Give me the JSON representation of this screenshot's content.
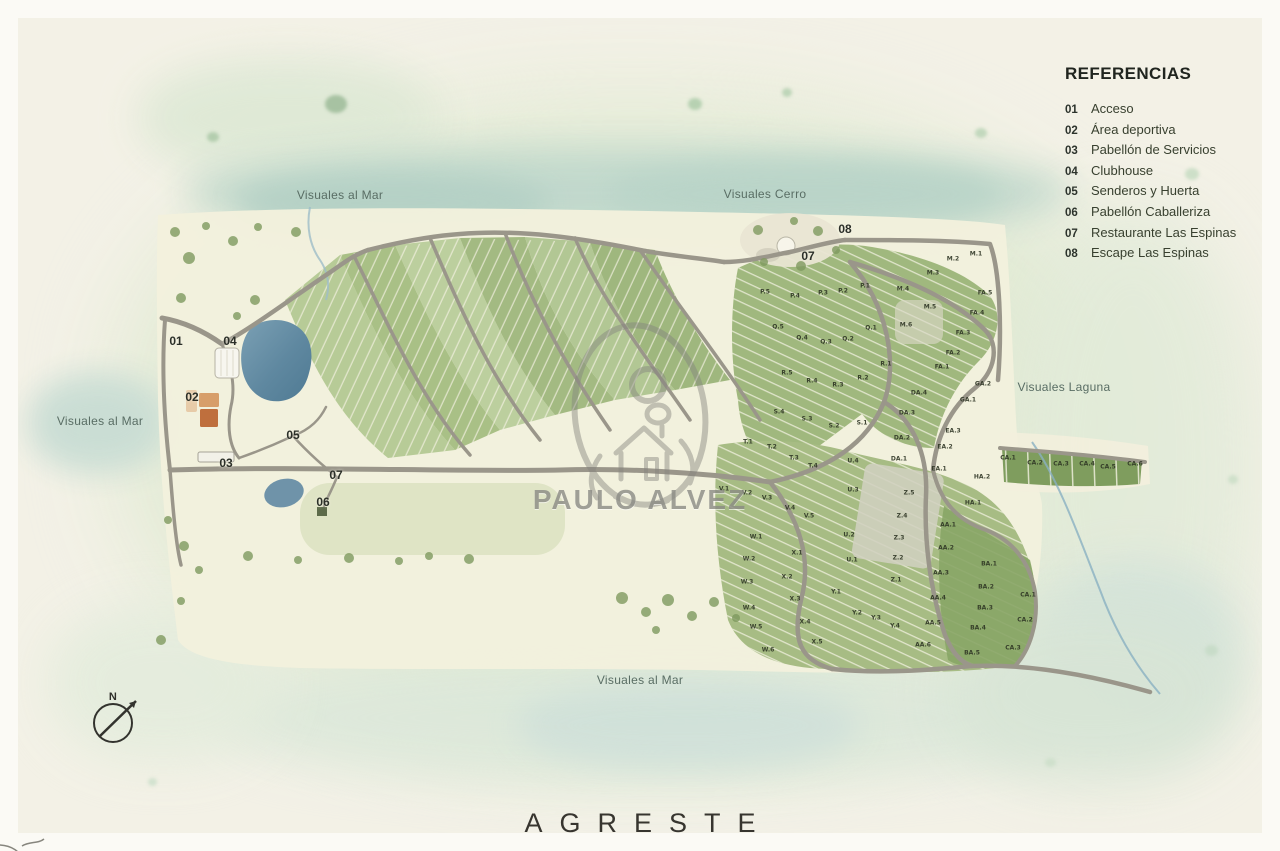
{
  "page": {
    "brand": "AGRESTE",
    "watermark": "PAULO ALVEZ",
    "compass_label": "N"
  },
  "legend": {
    "title": "REFERENCIAS",
    "items": [
      {
        "num": "01",
        "label": "Acceso"
      },
      {
        "num": "02",
        "label": "Área deportiva"
      },
      {
        "num": "03",
        "label": "Pabellón de Servicios"
      },
      {
        "num": "04",
        "label": "Clubhouse"
      },
      {
        "num": "05",
        "label": "Senderos y Huerta"
      },
      {
        "num": "06",
        "label": "Pabellón Caballeriza"
      },
      {
        "num": "07",
        "label": "Restaurante Las Espinas"
      },
      {
        "num": "08",
        "label": "Escape Las Espinas"
      }
    ]
  },
  "map": {
    "view_labels": [
      {
        "text": "Visuales al Mar",
        "x": 340,
        "y": 195
      },
      {
        "text": "Visuales Cerro",
        "x": 765,
        "y": 194
      },
      {
        "text": "Visuales al Mar",
        "x": 100,
        "y": 421
      },
      {
        "text": "Visuales Laguna",
        "x": 1064,
        "y": 387
      },
      {
        "text": "Visuales al Mar",
        "x": 640,
        "y": 680
      }
    ],
    "markers": [
      {
        "num": "01",
        "x": 176,
        "y": 341
      },
      {
        "num": "02",
        "x": 192,
        "y": 397
      },
      {
        "num": "03",
        "x": 226,
        "y": 463
      },
      {
        "num": "04",
        "x": 230,
        "y": 341
      },
      {
        "num": "05",
        "x": 293,
        "y": 435
      },
      {
        "num": "06",
        "x": 323,
        "y": 502
      },
      {
        "num": "07",
        "x": 336,
        "y": 475
      },
      {
        "num": "07",
        "x": 808,
        "y": 256
      },
      {
        "num": "08",
        "x": 845,
        "y": 229
      }
    ],
    "lots": [
      {
        "code": "P.5",
        "x": 765,
        "y": 292
      },
      {
        "code": "P.4",
        "x": 795,
        "y": 296
      },
      {
        "code": "P.3",
        "x": 823,
        "y": 293
      },
      {
        "code": "P.2",
        "x": 843,
        "y": 291
      },
      {
        "code": "P.1",
        "x": 865,
        "y": 286
      },
      {
        "code": "M.4",
        "x": 903,
        "y": 289
      },
      {
        "code": "M.3",
        "x": 933,
        "y": 273
      },
      {
        "code": "M.2",
        "x": 953,
        "y": 259
      },
      {
        "code": "M.1",
        "x": 976,
        "y": 254
      },
      {
        "code": "M.5",
        "x": 930,
        "y": 307
      },
      {
        "code": "M.6",
        "x": 906,
        "y": 325
      },
      {
        "code": "Q.5",
        "x": 778,
        "y": 327
      },
      {
        "code": "Q.4",
        "x": 802,
        "y": 338
      },
      {
        "code": "Q.3",
        "x": 826,
        "y": 342
      },
      {
        "code": "Q.2",
        "x": 848,
        "y": 339
      },
      {
        "code": "Q.1",
        "x": 871,
        "y": 328
      },
      {
        "code": "R.5",
        "x": 787,
        "y": 373
      },
      {
        "code": "R.4",
        "x": 812,
        "y": 381
      },
      {
        "code": "R.3",
        "x": 838,
        "y": 385
      },
      {
        "code": "R.2",
        "x": 863,
        "y": 378
      },
      {
        "code": "R.1",
        "x": 886,
        "y": 364
      },
      {
        "code": "S.4",
        "x": 779,
        "y": 412
      },
      {
        "code": "S.3",
        "x": 807,
        "y": 419
      },
      {
        "code": "S.2",
        "x": 834,
        "y": 426
      },
      {
        "code": "S.1",
        "x": 862,
        "y": 423
      },
      {
        "code": "T.1",
        "x": 748,
        "y": 442
      },
      {
        "code": "T.2",
        "x": 772,
        "y": 447
      },
      {
        "code": "T.3",
        "x": 794,
        "y": 458
      },
      {
        "code": "T.4",
        "x": 813,
        "y": 466
      },
      {
        "code": "U.4",
        "x": 853,
        "y": 461
      },
      {
        "code": "U.3",
        "x": 853,
        "y": 490
      },
      {
        "code": "U.2",
        "x": 849,
        "y": 535
      },
      {
        "code": "U.1",
        "x": 852,
        "y": 560
      },
      {
        "code": "V.1",
        "x": 724,
        "y": 489
      },
      {
        "code": "V.2",
        "x": 747,
        "y": 493
      },
      {
        "code": "V.3",
        "x": 767,
        "y": 498
      },
      {
        "code": "V.4",
        "x": 790,
        "y": 508
      },
      {
        "code": "V.5",
        "x": 809,
        "y": 516
      },
      {
        "code": "W.1",
        "x": 756,
        "y": 537
      },
      {
        "code": "W.2",
        "x": 749,
        "y": 559
      },
      {
        "code": "W.3",
        "x": 747,
        "y": 582
      },
      {
        "code": "W.4",
        "x": 749,
        "y": 608
      },
      {
        "code": "W.5",
        "x": 756,
        "y": 627
      },
      {
        "code": "W.6",
        "x": 768,
        "y": 650
      },
      {
        "code": "X.1",
        "x": 797,
        "y": 553
      },
      {
        "code": "X.2",
        "x": 787,
        "y": 577
      },
      {
        "code": "X.3",
        "x": 795,
        "y": 599
      },
      {
        "code": "X.4",
        "x": 805,
        "y": 622
      },
      {
        "code": "X.5",
        "x": 817,
        "y": 642
      },
      {
        "code": "Y.1",
        "x": 836,
        "y": 592
      },
      {
        "code": "Y.2",
        "x": 857,
        "y": 613
      },
      {
        "code": "Y.3",
        "x": 876,
        "y": 618
      },
      {
        "code": "Y.4",
        "x": 895,
        "y": 626
      },
      {
        "code": "Z.5",
        "x": 909,
        "y": 493
      },
      {
        "code": "Z.4",
        "x": 902,
        "y": 516
      },
      {
        "code": "Z.3",
        "x": 899,
        "y": 538
      },
      {
        "code": "Z.2",
        "x": 898,
        "y": 558
      },
      {
        "code": "Z.1",
        "x": 896,
        "y": 580
      },
      {
        "code": "AA.1",
        "x": 948,
        "y": 525
      },
      {
        "code": "AA.2",
        "x": 946,
        "y": 548
      },
      {
        "code": "AA.3",
        "x": 941,
        "y": 573
      },
      {
        "code": "AA.4",
        "x": 938,
        "y": 598
      },
      {
        "code": "AA.5",
        "x": 933,
        "y": 623
      },
      {
        "code": "AA.6",
        "x": 923,
        "y": 645
      },
      {
        "code": "BA.1",
        "x": 989,
        "y": 564
      },
      {
        "code": "BA.2",
        "x": 986,
        "y": 587
      },
      {
        "code": "BA.3",
        "x": 985,
        "y": 608
      },
      {
        "code": "BA.4",
        "x": 978,
        "y": 628
      },
      {
        "code": "BA.5",
        "x": 972,
        "y": 653
      },
      {
        "code": "CA.1",
        "x": 1028,
        "y": 595
      },
      {
        "code": "CA.2",
        "x": 1025,
        "y": 620
      },
      {
        "code": "CA.3",
        "x": 1013,
        "y": 648
      },
      {
        "code": "CA.1",
        "x": 1008,
        "y": 458
      },
      {
        "code": "CA.2",
        "x": 1035,
        "y": 463
      },
      {
        "code": "CA.3",
        "x": 1061,
        "y": 464
      },
      {
        "code": "CA.4",
        "x": 1087,
        "y": 464
      },
      {
        "code": "CA.5",
        "x": 1108,
        "y": 467
      },
      {
        "code": "CA.6",
        "x": 1135,
        "y": 464
      },
      {
        "code": "DA.1",
        "x": 899,
        "y": 459
      },
      {
        "code": "DA.2",
        "x": 902,
        "y": 438
      },
      {
        "code": "DA.3",
        "x": 907,
        "y": 413
      },
      {
        "code": "DA.4",
        "x": 919,
        "y": 393
      },
      {
        "code": "EA.1",
        "x": 939,
        "y": 469
      },
      {
        "code": "EA.2",
        "x": 945,
        "y": 447
      },
      {
        "code": "EA.3",
        "x": 953,
        "y": 431
      },
      {
        "code": "FA.1",
        "x": 942,
        "y": 367
      },
      {
        "code": "FA.2",
        "x": 953,
        "y": 353
      },
      {
        "code": "FA.3",
        "x": 963,
        "y": 333
      },
      {
        "code": "FA.4",
        "x": 977,
        "y": 313
      },
      {
        "code": "FA.5",
        "x": 985,
        "y": 293
      },
      {
        "code": "GA.1",
        "x": 968,
        "y": 400
      },
      {
        "code": "GA.2",
        "x": 983,
        "y": 384
      },
      {
        "code": "HA.1",
        "x": 973,
        "y": 503
      },
      {
        "code": "HA.2",
        "x": 982,
        "y": 477
      }
    ]
  },
  "colors": {
    "road": "#9a968a",
    "water": "#6d93ab",
    "lot_green": "#a9c086",
    "plat_cream": "#f3f0dd",
    "sport_orange": "#bf6f3d",
    "ink": "#2b2f28",
    "teal_wash": "#c0d8cc"
  }
}
